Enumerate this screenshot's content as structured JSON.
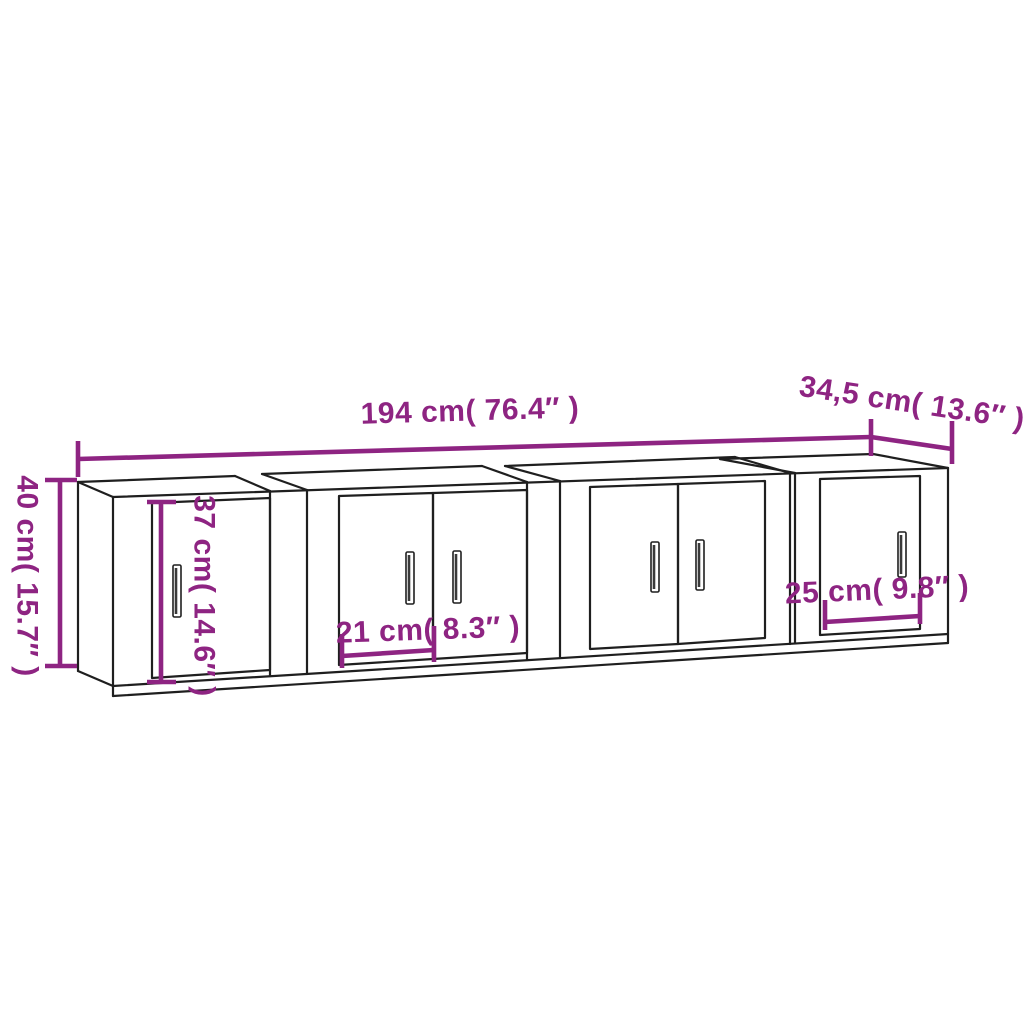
{
  "page": {
    "background": "#ffffff"
  },
  "diagram": {
    "kind": "product-dimension-drawing",
    "subject": "wall-mounted cabinet set of 4 units with 6 doors",
    "cabinet_count": 4,
    "door_count": 6,
    "colors": {
      "dimension_accent": "#8e2482",
      "outline": "#1f1f1f",
      "background": "#ffffff"
    },
    "labels": {
      "total_width": "194 cm( 76.4″ )",
      "depth": "34,5 cm( 13.6″ )",
      "height": "40 cm( 15.7″ )",
      "door_height": "37 cm( 14.6″ )",
      "door_width": "21 cm( 8.3″ )",
      "side_door_width": "25 cm( 9.8″ )"
    }
  }
}
